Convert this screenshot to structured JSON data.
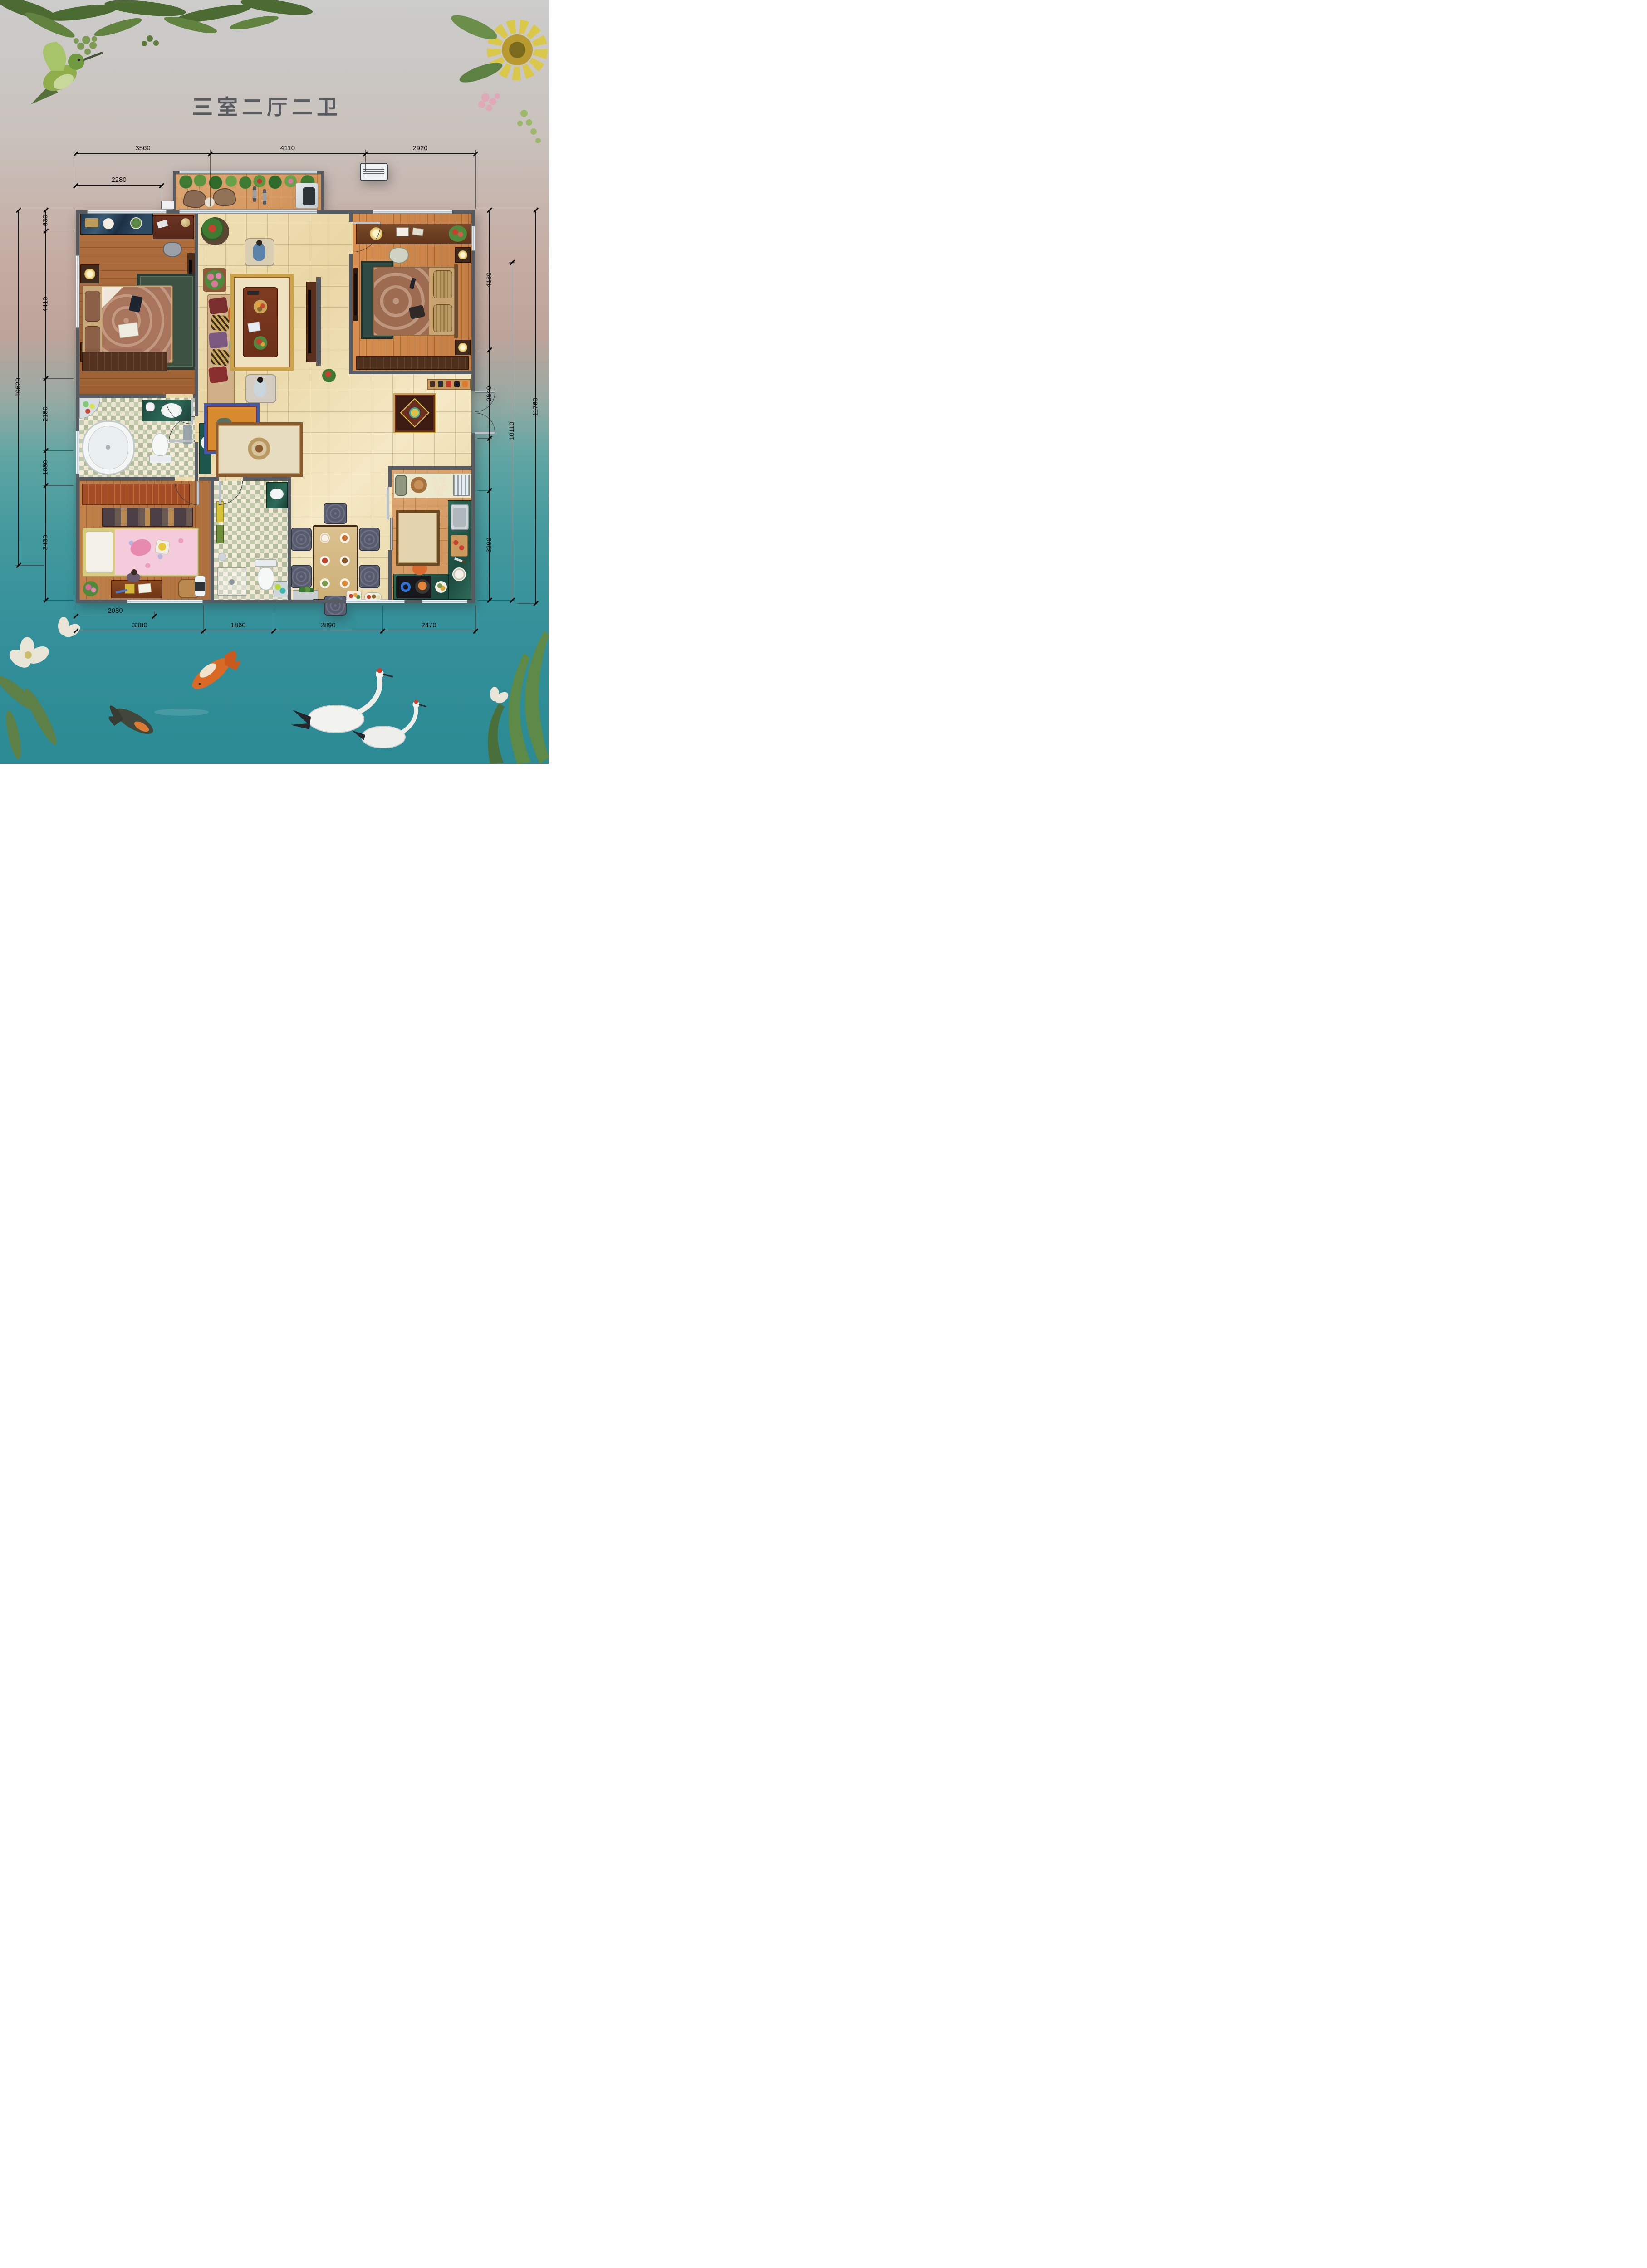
{
  "title": "三室二厅二卫",
  "dims": {
    "top1": [
      "3560",
      "4110",
      "2920"
    ],
    "top2": [
      "2280"
    ],
    "left_outer": "10620",
    "left_inner": [
      "630",
      "4410",
      "2150",
      "1050",
      "3430"
    ],
    "right_inner": [
      "4180",
      "2640",
      "3290"
    ],
    "right_mid": "10110",
    "right_outer": "11760",
    "bottom1": [
      "2080"
    ],
    "bottom2": [
      "3380",
      "1860",
      "2890",
      "2470"
    ]
  },
  "colors": {
    "wall": "#565c62",
    "dim_line": "#111111",
    "title_text": "#585c60",
    "tile_beige": "#ecdcaf",
    "wood_master": "#a5673a",
    "wood_kids": "#b97f47",
    "terracotta": "#d49a66",
    "water_teal": "#2f939a"
  }
}
